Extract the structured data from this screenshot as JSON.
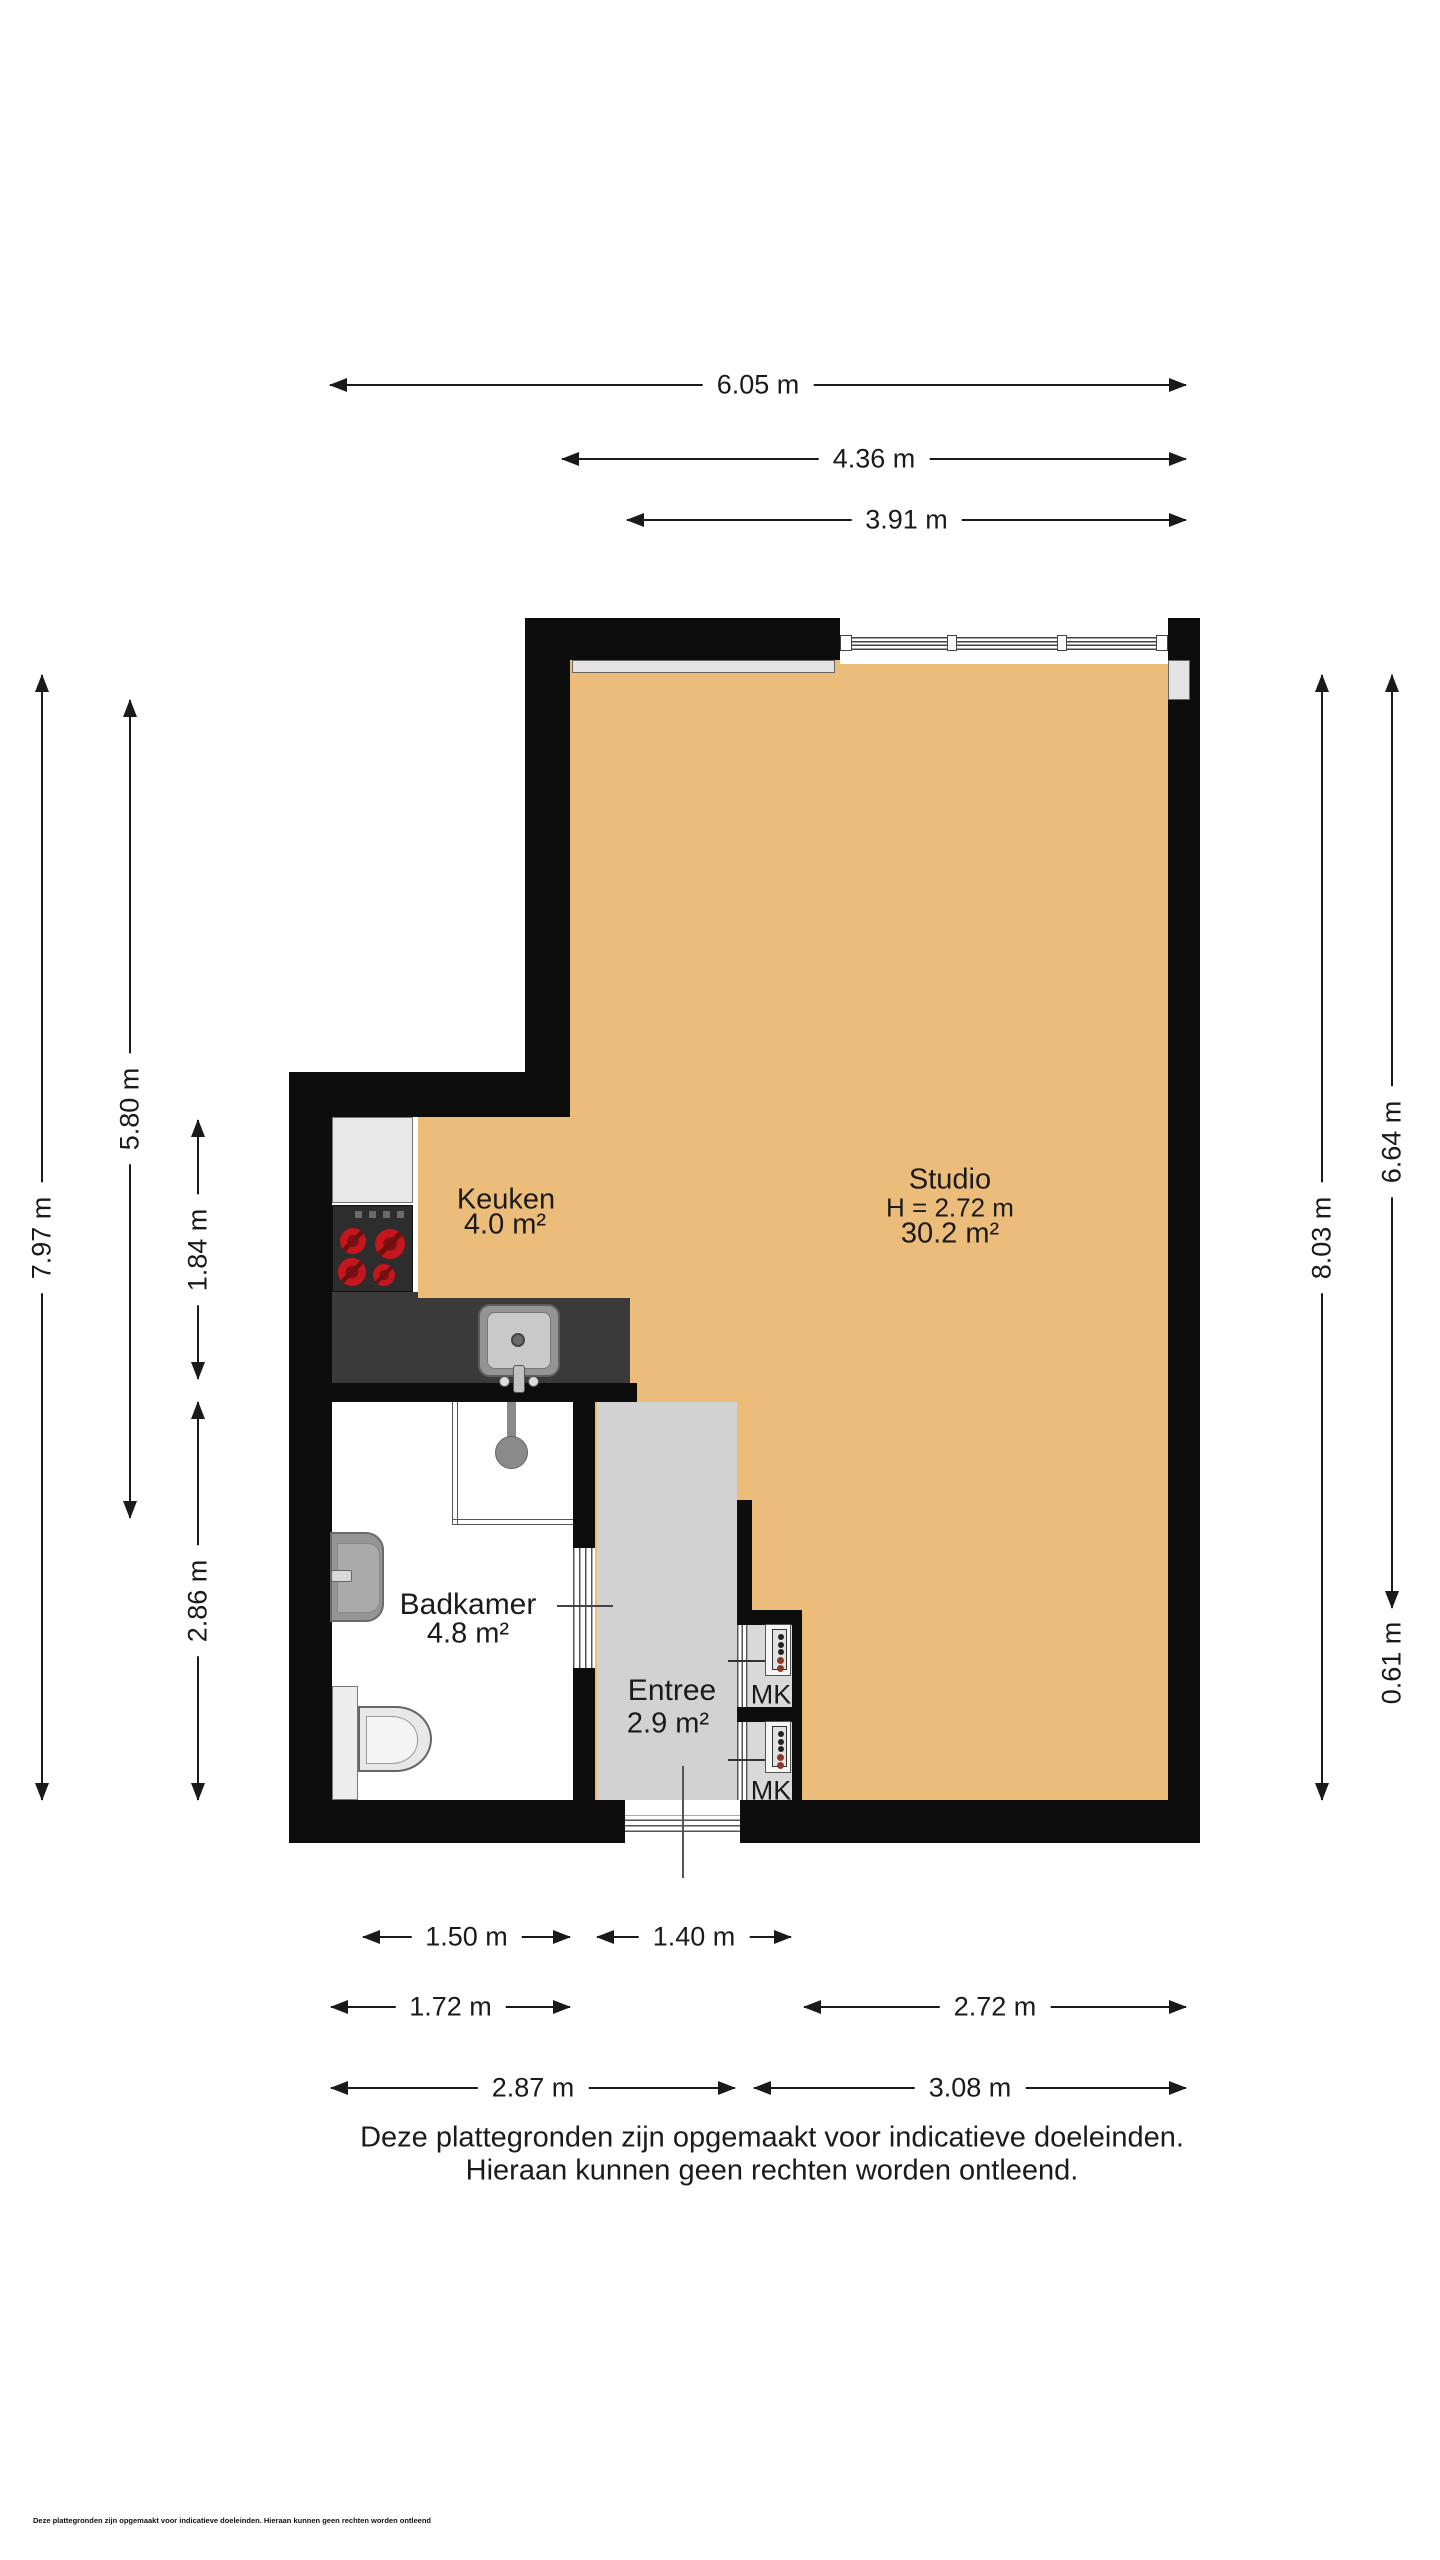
{
  "rooms": {
    "keuken": {
      "name": "Keuken",
      "area": "4.0 m²"
    },
    "studio": {
      "name": "Studio",
      "height": "H = 2.72 m",
      "area": "30.2 m²"
    },
    "badkamer": {
      "name": "Badkamer",
      "area": "4.8 m²"
    },
    "entree": {
      "name": "Entree",
      "area": "2.9 m²"
    },
    "mk1": {
      "name": "MK"
    },
    "mk2": {
      "name": "MK"
    }
  },
  "dimensions": {
    "top": [
      "6.05 m",
      "4.36 m",
      "3.91 m"
    ],
    "left": [
      "7.97 m",
      "5.80 m",
      "1.84 m",
      "2.86 m"
    ],
    "right": [
      "8.03 m",
      "6.64 m",
      "0.61 m"
    ],
    "bottom": [
      "1.50 m",
      "1.40 m",
      "1.72 m",
      "2.72 m",
      "2.87 m",
      "3.08 m"
    ]
  },
  "disclaimer": {
    "line1": "Deze plattegronden zijn opgemaakt voor indicatieve doeleinden.",
    "line2": "Hieraan kunnen geen rechten worden ontleend."
  },
  "fine_print": "Deze plattegronden zijn opgemaakt voor indicatieve doeleinden. Hieraan kunnen geen rechten worden ontleend",
  "colors": {
    "floor_orange": "#ecbd7a",
    "floor_entree": "#d2d2d2",
    "wall_black": "#0d0d0d",
    "counter_dark": "#3a3a3a",
    "burner_red": "#c4161c"
  }
}
